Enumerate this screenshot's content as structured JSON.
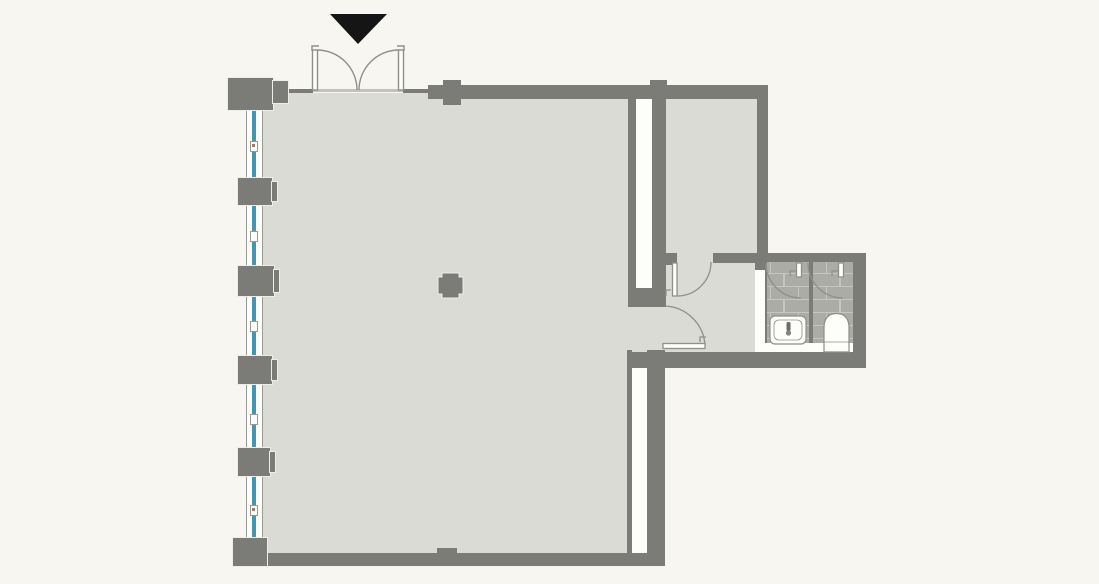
{
  "meta": {
    "kind": "architectural-floor-plan",
    "canvas_width_px": 1099,
    "canvas_height_px": 584,
    "text_content": "none - drawing contains no visible text or labels"
  },
  "colors": {
    "background": "#f7f6f0",
    "floor": "#dbdbd5",
    "wall": "#7b7b78",
    "pillar_rim": "#eeeee8",
    "window_white": "#fdfdfa",
    "window_frame": "#9a9a95",
    "glass": "#4695b3",
    "cavity_white": "#fdfdfa",
    "tile": "#acaca6",
    "tile_mortar": "#c6c6c0",
    "door_line": "#90908b",
    "fixture_outline": "#8e8e89",
    "fixture_white": "#fdfdfa",
    "threshold": "#c2c2bc",
    "entrance_marker": "#151515",
    "accent_dot": "#b0755f"
  },
  "inventory": {
    "entrance_marker": "black downward triangle above double entrance doors",
    "entrance_doors": "double outswing doors with quarter-circle swing arcs",
    "window_bays": 5,
    "facade_pillars": 6,
    "center_column": 1,
    "rooms": [
      "large main hall",
      "side room top-right",
      "small vestibule",
      "two wc stalls with tiled floor"
    ],
    "interior_doors": 4,
    "fixtures": [
      "wash basin with faucet",
      "toilet"
    ]
  }
}
